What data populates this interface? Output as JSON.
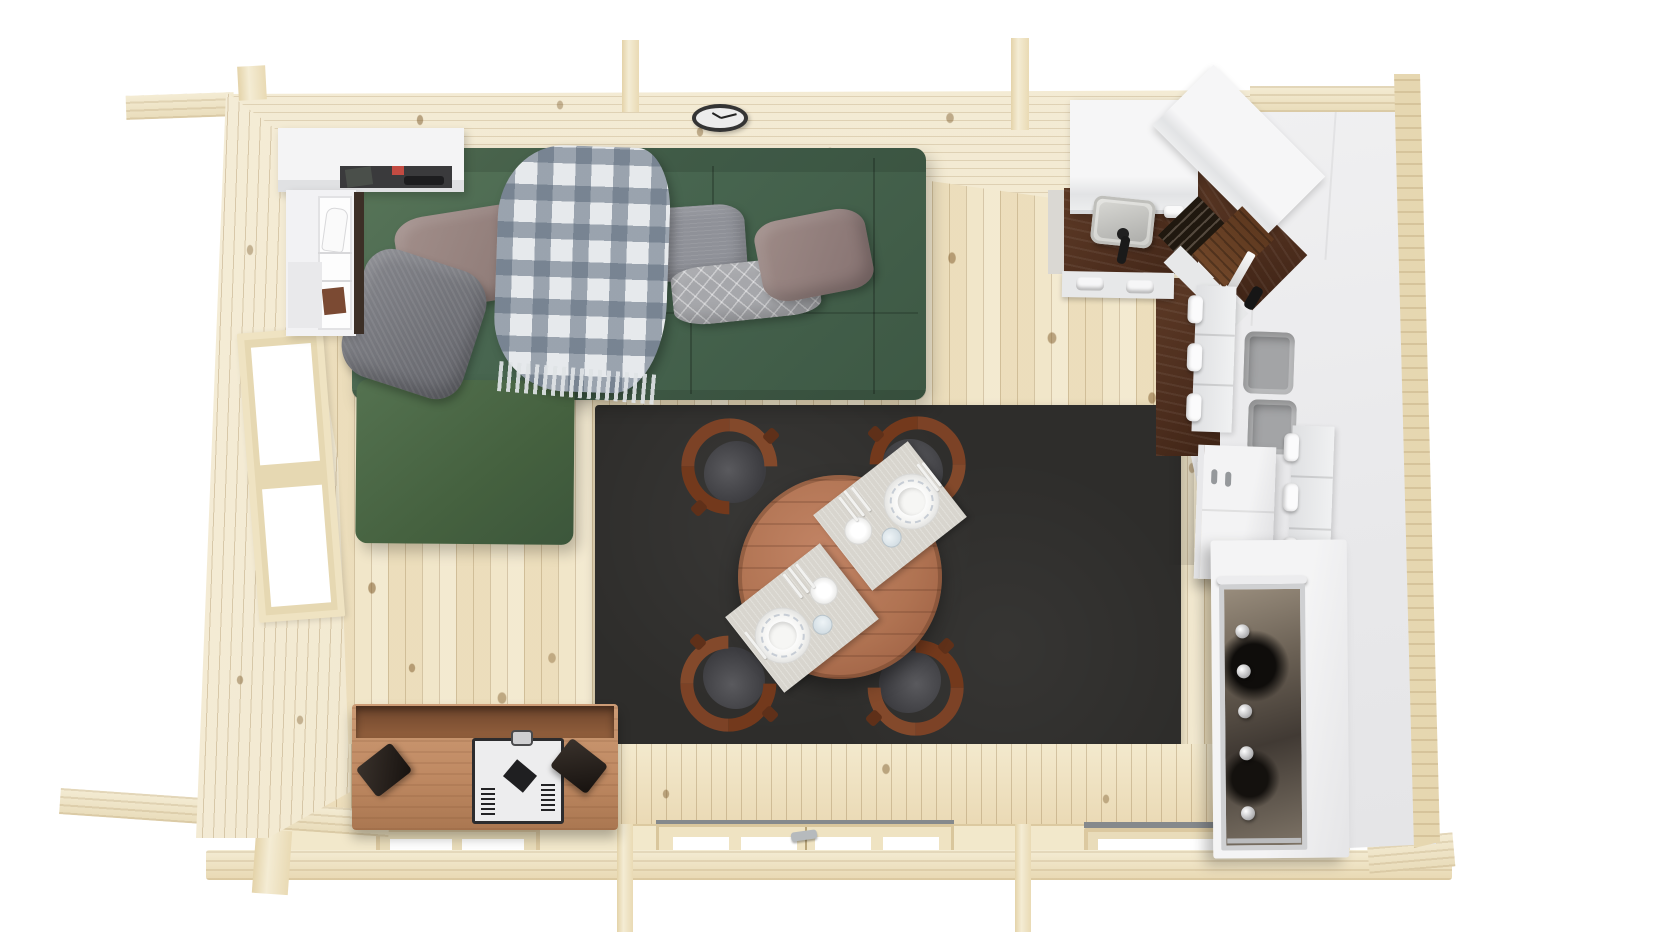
{
  "scene": {
    "title": "Log cabin interior - top-down 3D floor plan render",
    "view": "overhead orthographic-style render with mild perspective",
    "background": "#ffffff",
    "rooms": "open plan living room, dining area and kitchen"
  },
  "palette": {
    "floor_wood": "#f1e6c9",
    "wall_wood": "#efe5cd",
    "counter_walnut": "#4c2d1d",
    "rug": "#2e2d2b",
    "sofa_green": "#486650",
    "chaise_green": "#45613f",
    "pillow_taupe": "#8a7672",
    "pillow_gray": "#63646a",
    "pillow_silver": "#8f9198",
    "pillow_pattern": "#a6a7ab",
    "blanket_base": "#e6e9ec",
    "blanket_check": "#5c6a7c",
    "cabinet_white": "#ededee",
    "bin_gray": "#a3a4a6",
    "table_wood": "#b07352",
    "chair_wood": "#7c4226",
    "chair_seat": "#3c3c40",
    "mat_gray": "#d8d5ce",
    "stand_wood": "#c08a63",
    "stand_inner": "#93603d",
    "stove_white": "#ededee",
    "stove_frame": "#2c2c2e",
    "speaker_black": "#17120f",
    "window_white": "#ffffff",
    "sill_gray": "#85898c",
    "clock_rim": "#343434",
    "clock_face": "#ececec"
  },
  "structure": {
    "walls_label": "Pale pine log walls with protruding corner joints and roof beams",
    "floor_label": "Vertical pine floor planks with knots",
    "left_window_label": "Two-pane window in left wall",
    "bottom_openings": [
      "Two-pane window",
      "Double glass door with handle",
      "Wide single-pane window"
    ],
    "roof_beam_count": 2
  },
  "living_room": {
    "sofa": {
      "label": "Green L-shaped sectional sofa with chaise",
      "color_name": "forest green"
    },
    "pillows": [
      {
        "label": "Taupe square pillow (left)"
      },
      {
        "label": "Dark gray textured pillow"
      },
      {
        "label": "Silver gray gathered pillow"
      },
      {
        "label": "Light gray diamond-pattern lumbar pillow"
      },
      {
        "label": "Taupe square pillow (right)"
      }
    ],
    "blanket": {
      "label": "Blue-gray gingham checkered throw with fringe"
    },
    "shelf_unit": {
      "label": "White corner shelf unit",
      "items": [
        "dark bag",
        "red box",
        "remote control",
        "white shoe",
        "brown box"
      ]
    },
    "clock": {
      "label": "Round wall clock",
      "time_shown": "10:10"
    },
    "tv_stand": {
      "label": "Wooden media console",
      "items": [
        "white stove-style unit with vents and knob",
        "black speaker left",
        "black speaker right",
        "small green item"
      ]
    }
  },
  "dining_area": {
    "rug": {
      "label": "Large charcoal area rug"
    },
    "table": {
      "label": "Round wooden dining table",
      "seats": 4
    },
    "chairs": {
      "label": "Curved-back wooden chair with gray seat",
      "count": 4
    },
    "place_settings": {
      "count": 2,
      "items": [
        "woven placemat",
        "dinner plate with patterned rim",
        "side plate",
        "cup",
        "cutlery"
      ]
    }
  },
  "kitchen": {
    "upper_cabinets": {
      "label": "White wall cabinets along top wall and corner"
    },
    "base_cabinets": {
      "label": "White base cabinets with recessed slot handles"
    },
    "countertop": {
      "label": "Dark walnut L-shaped countertop"
    },
    "sink": {
      "label": "Inset sink with black faucet"
    },
    "hob": {
      "label": "Dark slatted hob / grill plate"
    },
    "cutting_board": {
      "label": "Wooden slatted board"
    },
    "knife": {
      "label": "Chef knife on counter"
    },
    "drawers": {
      "label": "Drawer stacks with C-shaped handles",
      "handle_count": 6
    },
    "storage_bins": {
      "label": "Gray storage bins in open shelf",
      "count": 2
    },
    "cabinet_cart": {
      "label": "Small white two-door cabinet with pin handles"
    },
    "oven": {
      "label": "Range cooker with glass door, handle and knobs",
      "knob_count": 5
    },
    "tall_cabinets": {
      "label": "Tall white cabinet run along right wall"
    }
  }
}
